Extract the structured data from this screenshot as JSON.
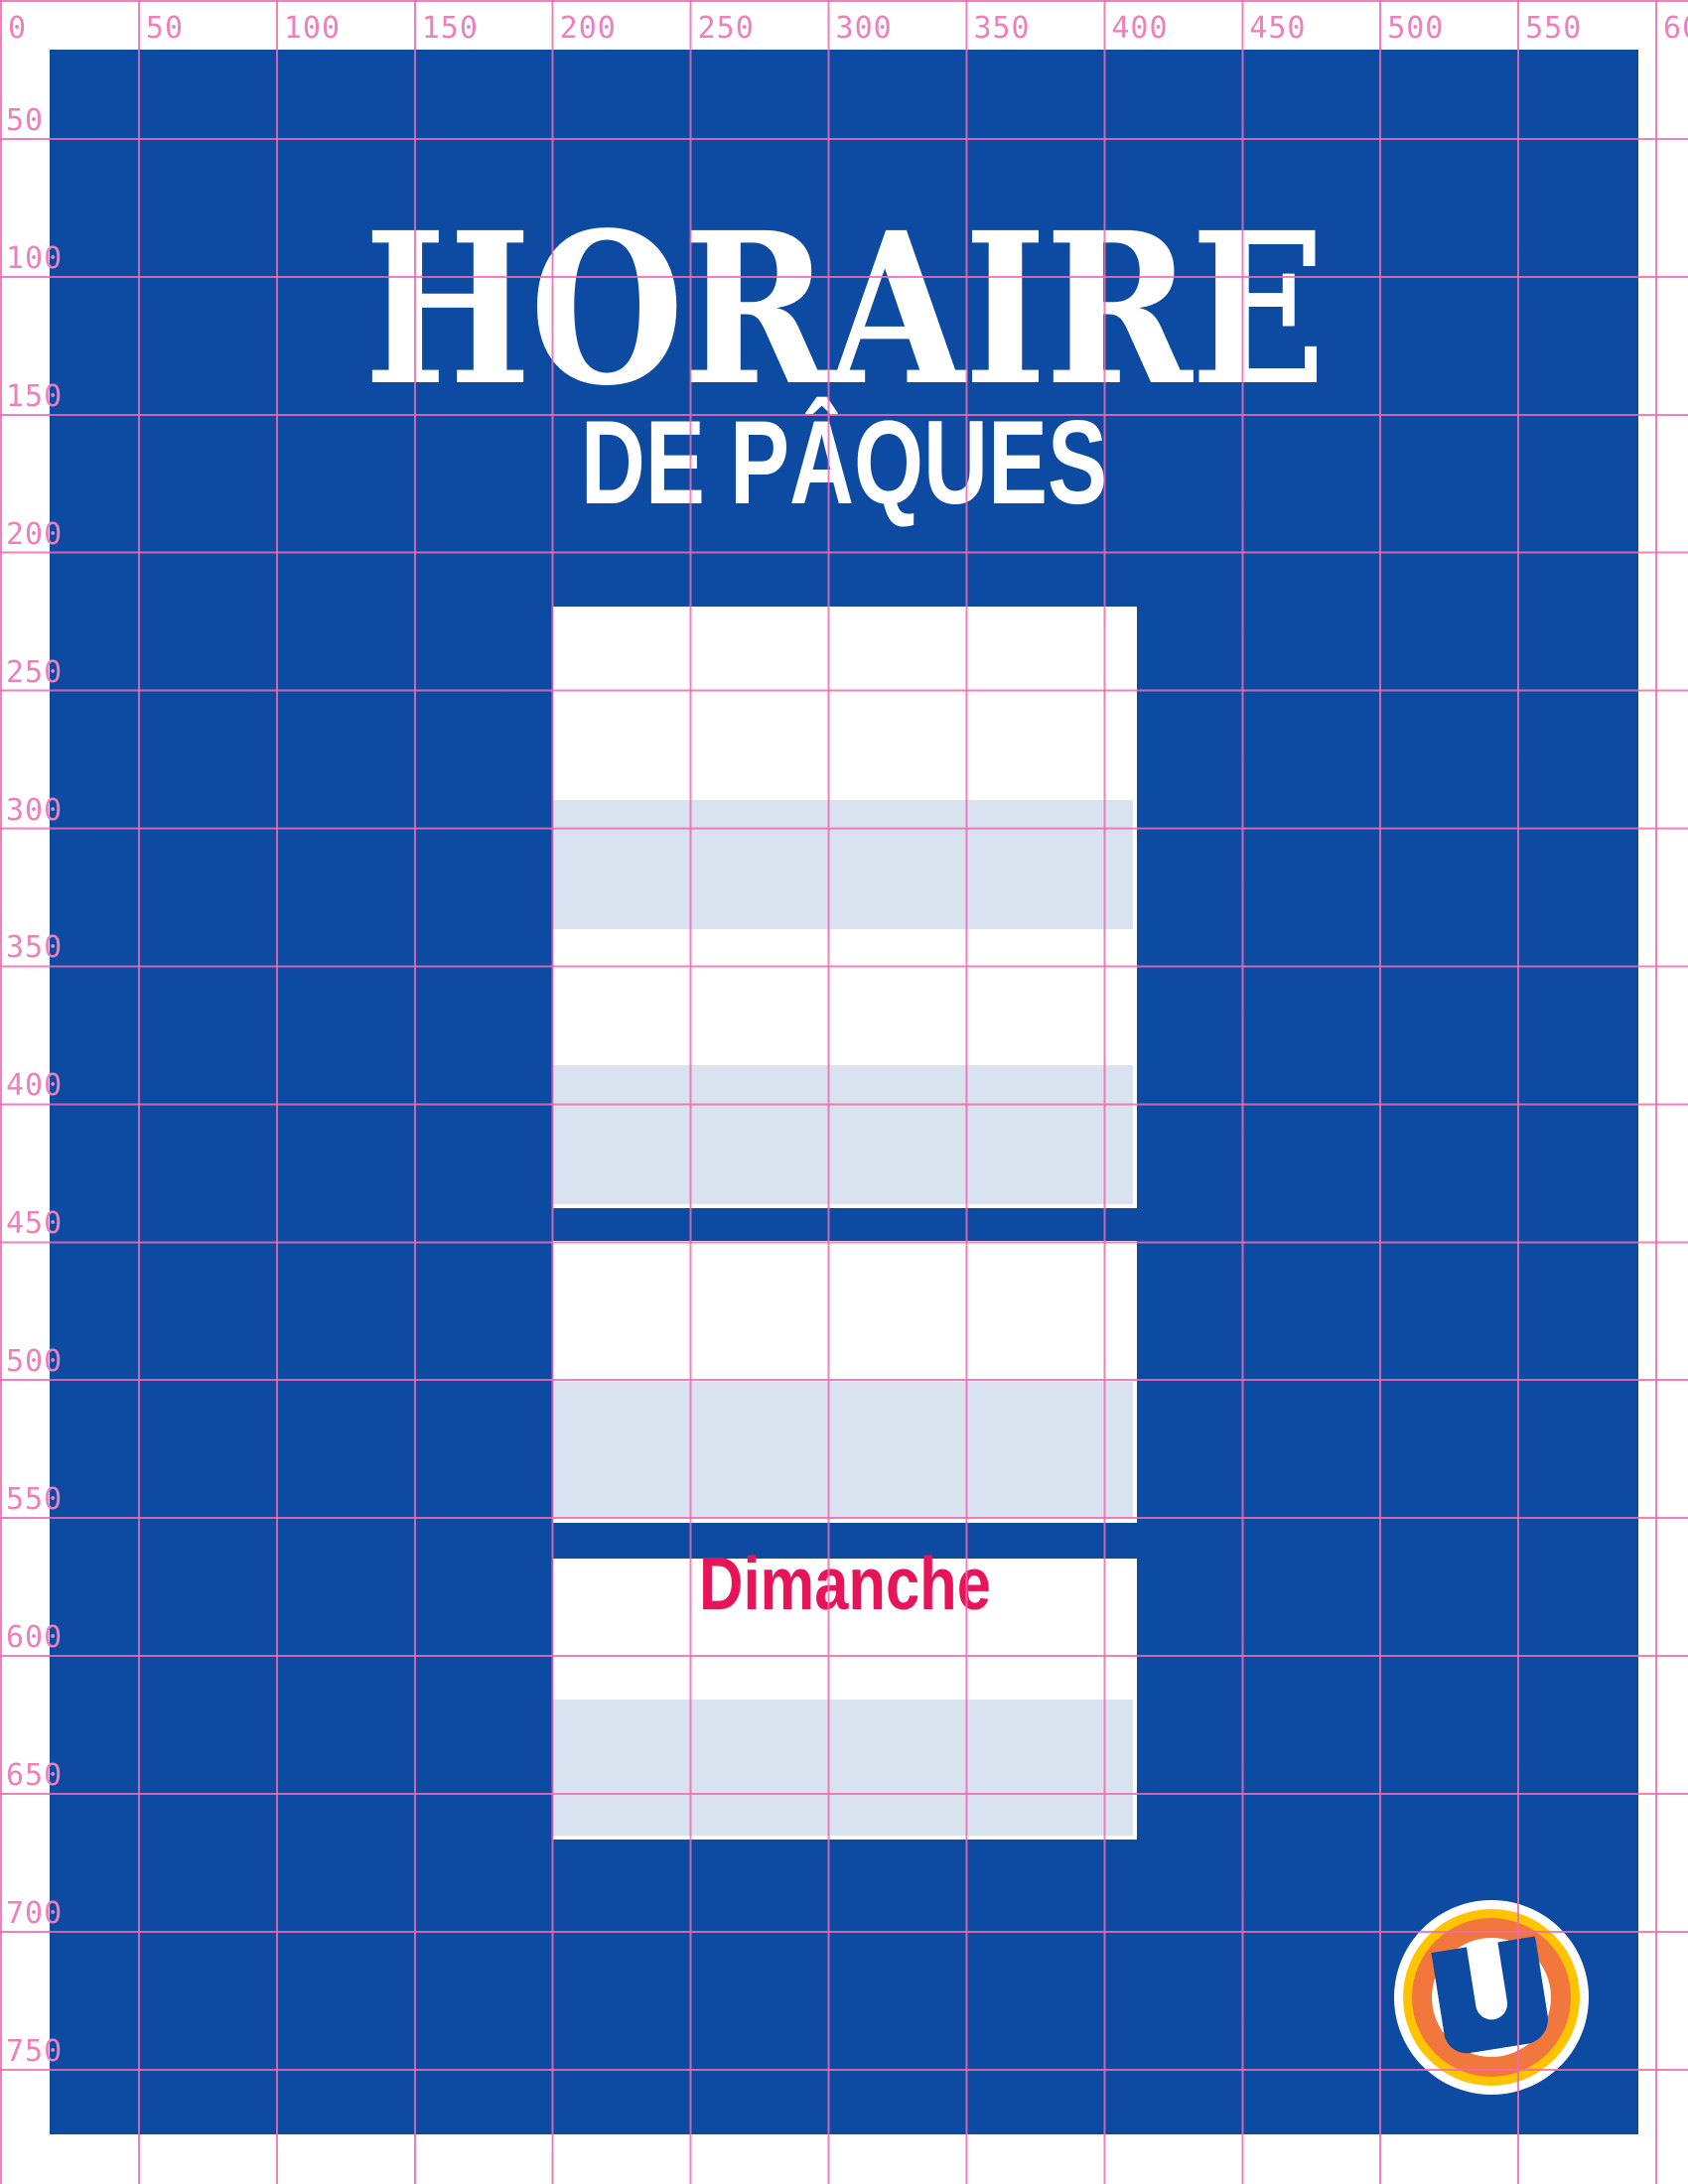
{
  "poster": {
    "title": "HORAIRE",
    "subtitle": "DE PÂQUES"
  },
  "schedule": {
    "day_label": "Dimanche",
    "groups": 4,
    "rows_per_group": 2
  },
  "logo": {
    "letter": "U",
    "brand": "U"
  },
  "grid": {
    "top_labels": [
      "0",
      "50",
      "100",
      "150",
      "200",
      "250",
      "300",
      "350",
      "400",
      "450",
      "500",
      "550",
      "600"
    ],
    "left_labels": [
      "50",
      "100",
      "150",
      "200",
      "250",
      "300",
      "350",
      "400",
      "450",
      "500",
      "550",
      "600",
      "650",
      "700",
      "750"
    ]
  },
  "colors": {
    "blue": "#0c4ba1",
    "row-gray": "#d9e2ef",
    "grid-line": "rgba(241,105,177,0.85)",
    "ruler-label": "#ee80bb",
    "day-red": "#e8145a",
    "logo-yellow": "#ffc400",
    "logo-orange": "#f2773d",
    "paper": "#ffffff"
  }
}
